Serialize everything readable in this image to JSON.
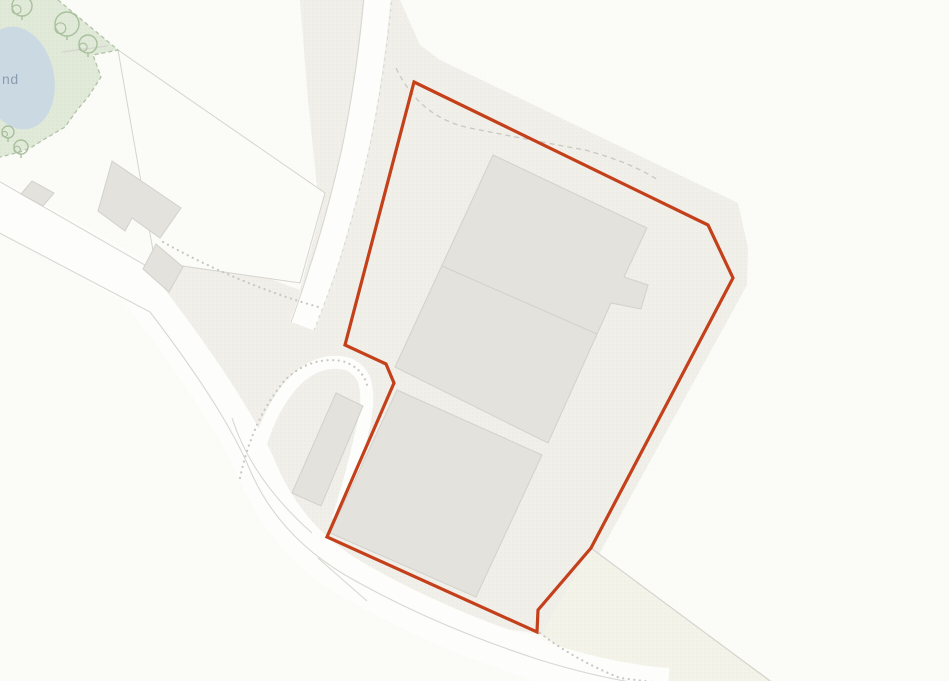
{
  "map": {
    "canvas": {
      "width": 949,
      "height": 681
    },
    "labels": {
      "pond_label": "nd"
    },
    "colors": {
      "background": "#fbfbf8",
      "base_dot": "#f1f0ea",
      "site_fill": "#f0efe9",
      "site_dot": "#e6e5dd",
      "cream_fill": "#f4f3e9",
      "cream_dot": "#eae9db",
      "green_fill": "#e1ead9",
      "green_dot": "#d7e2cd",
      "green_dash": "#b3c2a9",
      "tree_stroke": "#a9c09e",
      "pond_fill": "#cbd9e3",
      "pond_text": "#8a9cb0",
      "building_fill": "#e3e2dd",
      "building_stroke": "#d2d1cb",
      "road_fill": "#fdfdfb",
      "road_edge": "#d8d7d1",
      "parcel_line": "#d5d4ce",
      "path_dot": "#c9c8c2",
      "boundary_red": "#c4401a"
    },
    "boundary": {
      "name": "site-boundary-redline",
      "stroke_width": 3.2,
      "points": "414,82 708,225 733,278 591,548 538,610 537,632 327,537 394,383 386,364 345,345"
    },
    "regions": [
      {
        "name": "site-area-surround",
        "fill": "site",
        "points": "300,0 400,0 420,45 440,60 738,203 748,248 747,285 598,556 772,681 612,681 540,634 420,616 320,558 250,482 232,420 150,318 148,264 240,268 300,290 320,215 308,100"
      },
      {
        "name": "verge-wedge-southeast",
        "fill": "cream",
        "points": "591,548 770,681 614,681 541,635"
      },
      {
        "name": "field-parcel-triangle",
        "fill": "white",
        "stroke": true,
        "points": "118,50 325,193 300,283 155,262"
      },
      {
        "name": "green-vegetation-area",
        "fill": "green",
        "points": "0,0 58,0 118,50 93,55 101,77 88,97 77,110 65,127 43,140 32,147 20,152 0,157"
      }
    ],
    "roads": [
      {
        "name": "main-road-west",
        "d": "M -10,200 L 150,290",
        "width": 46
      },
      {
        "name": "road-bend-south",
        "d": "M 140,290 Q 225,400 255,465 Q 285,540 350,578 Q 435,628 542,662 Q 612,684 668,688",
        "width": 40
      },
      {
        "name": "north-lane",
        "d": "M 378,-5 Q 370,80 355,150 Q 340,215 323,268 Q 312,300 302,326",
        "width": 26
      },
      {
        "name": "farm-drive-loop",
        "d": "M 250,492 Q 260,420 292,384 Q 318,356 348,364 Q 364,371 366,388 Q 369,405 361,436 Q 352,476 338,520",
        "width": 13
      }
    ],
    "road_edges": [
      {
        "name": "main-road-nw-edge",
        "d": "M -10,176 L 150,268"
      },
      {
        "name": "main-road-se-edge",
        "d": "M -10,228 L 150,312 Q 225,410 250,470 Q 278,535 345,575 Q 432,625 540,660 Q 612,682 668,687"
      },
      {
        "name": "north-lane-west-edge",
        "d": "M 364,-5 Q 357,75 342,148 Q 327,215 310,266 Q 300,298 291,322"
      },
      {
        "name": "north-lane-east-edge",
        "d": "M 392,-5 Q 385,75 369,150 Q 353,220 336,272 Q 325,303 314,330",
        "dashed": true
      },
      {
        "name": "drive-ne-edge",
        "d": "M 232,418 Q 252,480 312,533"
      },
      {
        "name": "verge-line-sw",
        "d": "M 318,558 L 367,601"
      }
    ],
    "paths": [
      {
        "name": "junction-dotted-arc",
        "d": "M 163,242 Q 240,285 322,308",
        "style": "dotted"
      },
      {
        "name": "drive-outer-dotted-edge",
        "d": "M 240,478 Q 252,420 285,380 Q 310,356 342,361 Q 362,367 367,385",
        "style": "dotted"
      },
      {
        "name": "verge-dotted-edge",
        "d": "M 540,633 Q 575,660 620,678 L 660,683",
        "style": "dotted"
      },
      {
        "name": "site-track-dashed",
        "d": "M 396,68 Q 420,118 470,128 Q 530,140 585,150 Q 630,162 658,180",
        "style": "dashed"
      },
      {
        "name": "green-boundary-dashed",
        "d": "M 58,0 L 118,50 L 93,55 L 101,77 L 88,97 L 77,110 L 65,127 L 43,140 L 32,147 L 20,152 L 0,157",
        "style": "green-dash"
      }
    ],
    "parcel_lines": [
      {
        "name": "field-boundary-line-se",
        "d": "M 591,548 L 770,681"
      },
      {
        "name": "green-fence-line",
        "d": "M 62,52 L 108,46"
      }
    ],
    "buildings": [
      {
        "name": "warehouse-north",
        "points": "493,155 647,228 624,277 648,285 641,309 611,303 548,443 395,367"
      },
      {
        "name": "warehouse-south",
        "points": "397,390 542,455 476,597 330,533"
      },
      {
        "name": "outbuilding-long",
        "points": "336,393 363,406 321,506 292,493"
      },
      {
        "name": "farmhouse",
        "points": "112,161 181,208 160,238 132,218 125,231 98,211"
      },
      {
        "name": "barn-square",
        "points": "156,244 183,267 169,292 143,269"
      },
      {
        "name": "shed-small",
        "points": "32,181 54,193 43,206 21,194"
      }
    ],
    "building_lines": [
      {
        "name": "warehouse-divider-line",
        "d": "M 442,266 L 597,334"
      }
    ],
    "pond": {
      "name": "pond-water",
      "cx": 18,
      "cy": 78,
      "rx": 36,
      "ry": 52,
      "rotate": -12
    },
    "trees": [
      {
        "x": 67,
        "y": 24,
        "r": 12
      },
      {
        "x": 88,
        "y": 44,
        "r": 9
      },
      {
        "x": 22,
        "y": 6,
        "r": 10
      },
      {
        "x": 8,
        "y": 132,
        "r": 6
      },
      {
        "x": 21,
        "y": 147,
        "r": 7
      }
    ]
  }
}
